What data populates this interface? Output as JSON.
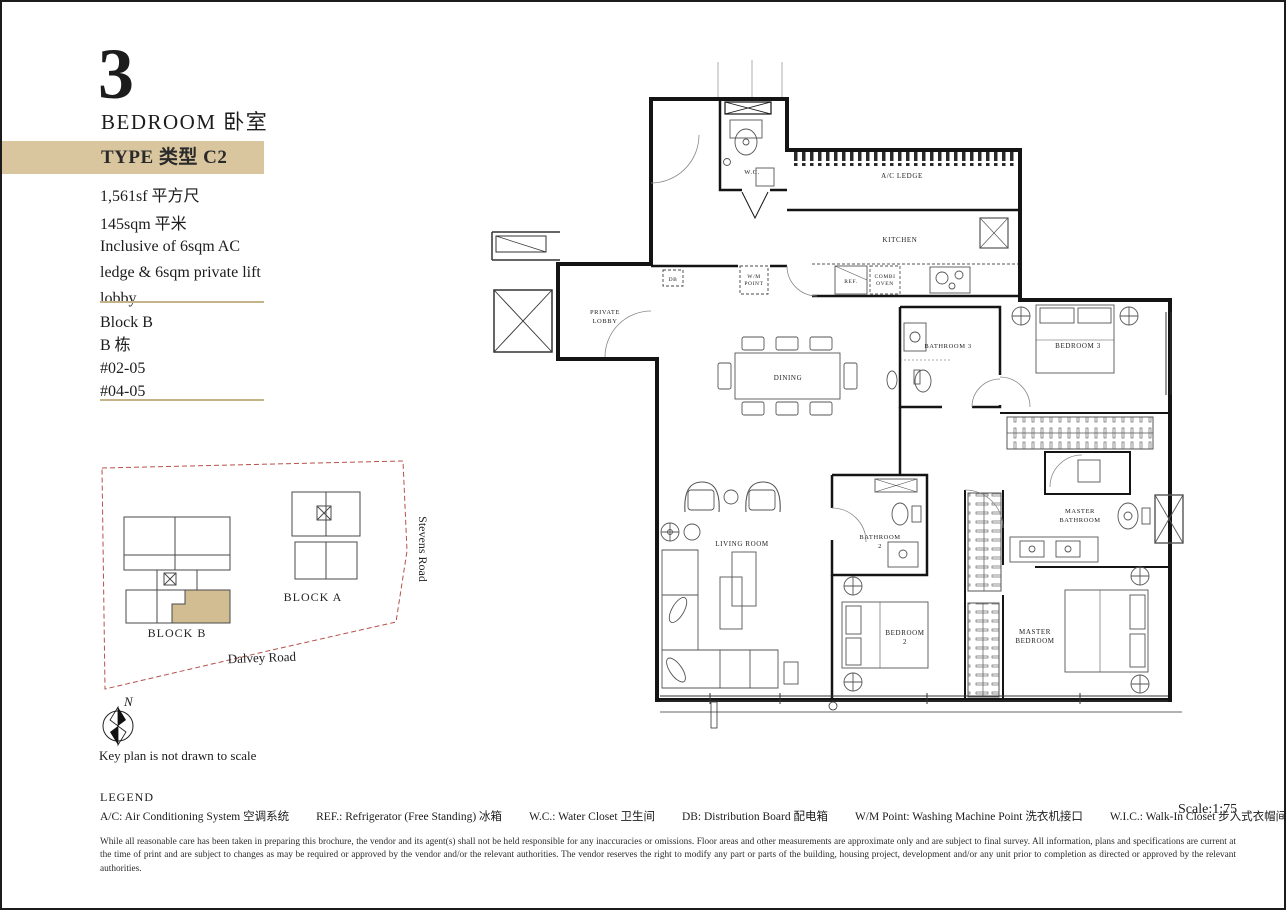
{
  "sidebar": {
    "bedrooms_number": "3",
    "bedrooms_label": "BEDROOM 卧室",
    "type_banner": "TYPE 类型 C2",
    "area_sf": "1,561sf 平方尺",
    "area_sqm": "145sqm 平米",
    "inclusive_note": "Inclusive of 6sqm AC ledge & 6sqm private lift lobby",
    "block": "Block B",
    "block_cn": "B 栋",
    "units": [
      "#02-05",
      "#04-05"
    ]
  },
  "key_plan": {
    "block_a": "BLOCK A",
    "block_b": "BLOCK B",
    "stevens_road": "Stevens Road",
    "dalvey_road": "Dalvey Road",
    "north": "N",
    "caption": "Key plan is not drawn to scale",
    "highlight_color": "#d2bc92",
    "boundary_color": "#b5524a"
  },
  "floor_plan": {
    "wc": "W.C.",
    "ac_ledge": "A/C LEDGE",
    "kitchen": "KITCHEN",
    "ref": "REF.",
    "combi_oven_1": "COMBI",
    "combi_oven_2": "OVEN",
    "wm_point_1": "W/M",
    "wm_point_2": "POINT",
    "db": "DB",
    "private_lobby_1": "PRIVATE",
    "private_lobby_2": "LOBBY",
    "dining": "DINING",
    "living_room": "LIVING ROOM",
    "bathroom3": "BATHROOM 3",
    "bedroom3": "BEDROOM 3",
    "bathroom2_1": "BATHROOM",
    "bathroom2_2": "2",
    "bedroom2_1": "BEDROOM",
    "bedroom2_2": "2",
    "master_bathroom_1": "MASTER",
    "master_bathroom_2": "BATHROOM",
    "master_bedroom_1": "MASTER",
    "master_bedroom_2": "BEDROOM"
  },
  "legend": {
    "title": "LEGEND",
    "items": [
      "A/C: Air Conditioning System 空调系统",
      "REF.: Refrigerator (Free Standing) 冰箱",
      "W.C.: Water Closet 卫生间",
      "DB: Distribution Board 配电箱",
      "W/M Point: Washing Machine Point 洗衣机接口",
      "W.I.C.: Walk-In Closet 步入式衣帽间"
    ]
  },
  "footer": {
    "scale": "Scale:1:75",
    "disclaimer": "While all reasonable care has been taken in preparing this brochure, the vendor and its agent(s) shall not be held responsible for any inaccuracies or omissions. Floor areas and other measurements are approximate only and are subject to final survey. All information, plans and specifications are current at the time of print and are subject to changes as may be required or approved by the vendor and/or the relevant authorities. The vendor reserves the right to modify any part or parts of the building, housing project, development and/or any unit prior to completion as directed or approved by the relevant authorities."
  }
}
